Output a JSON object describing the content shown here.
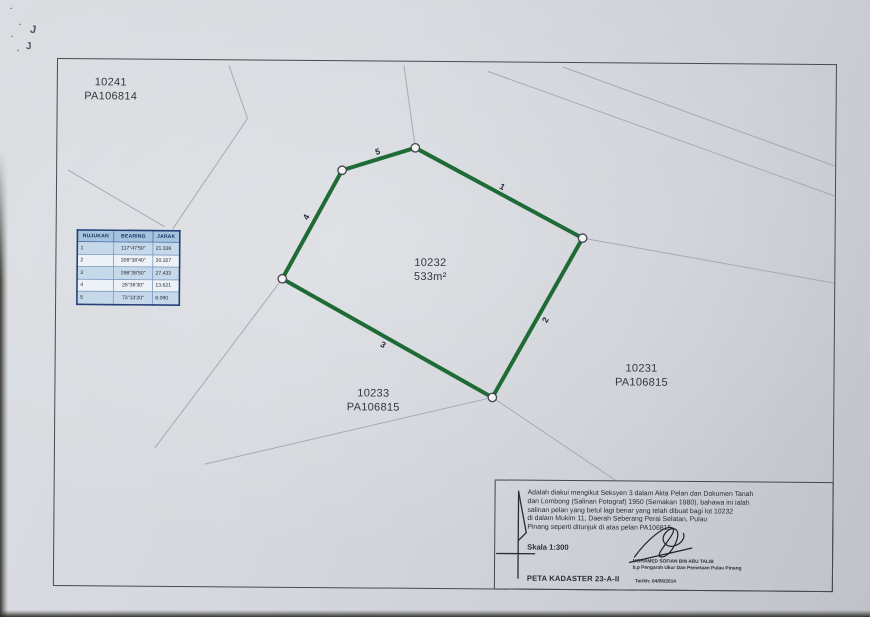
{
  "photo": {
    "marks": [
      "·",
      "·",
      "J",
      "·",
      "·",
      "J"
    ]
  },
  "map": {
    "parcels": {
      "neighbor_top_left": {
        "lot": "10241",
        "plan": "PA106814"
      },
      "subject": {
        "lot": "10232",
        "area": "533m²"
      },
      "neighbor_right": {
        "lot": "10231",
        "plan": "PA106815"
      },
      "neighbor_bottom": {
        "lot": "10233",
        "plan": "PA106815"
      }
    },
    "edge_numbers": [
      "1",
      "2",
      "3",
      "4",
      "5"
    ],
    "reference_table": {
      "headers": [
        "RUJUKAN",
        "BEARING",
        "JARAK"
      ],
      "rows": [
        {
          "rujukan": "1",
          "bearing": "117°47'50\"",
          "jarak": "21.336"
        },
        {
          "rujukan": "2",
          "bearing": "208°38'40\"",
          "jarak": "20.327"
        },
        {
          "rujukan": "3",
          "bearing": "298°38'50\"",
          "jarak": "27.433"
        },
        {
          "rujukan": "4",
          "bearing": "28°36'30\"",
          "jarak": "13.621"
        },
        {
          "rujukan": "5",
          "bearing": "73°13'20\"",
          "jarak": "8.090"
        }
      ]
    },
    "certificate": {
      "line1": "Adalah diakui mengikut Seksyen 3 dalam Akta Pelan dan Dokumen Tanah",
      "line2": "dan Lombong (Salinan Fotograf) 1950 (Semakan 1980), bahawa ini ialah",
      "line3": "salinan pelan yang betul lagi benar yang telah dibuat bagi lot 10232",
      "line4": "di dalam Mukim 11, Daerah Seberang Perai Selatan, Pulau",
      "line5": "Pinang seperti ditunjuk di atas pelan PA106815",
      "scale": "Skala 1:300",
      "sheet": "PETA KADASTER 23-A-II",
      "signatory": "MOHAMED SOFIAN BIN ABU TALIB",
      "signatory_title": "b.p Pengarah Ukur Dan Pemetaan Pulau Pinang",
      "date": "Tarikh: 04/06/2014"
    },
    "colors": {
      "boundary": "#1f6b36",
      "table_border": "#24407a"
    }
  }
}
